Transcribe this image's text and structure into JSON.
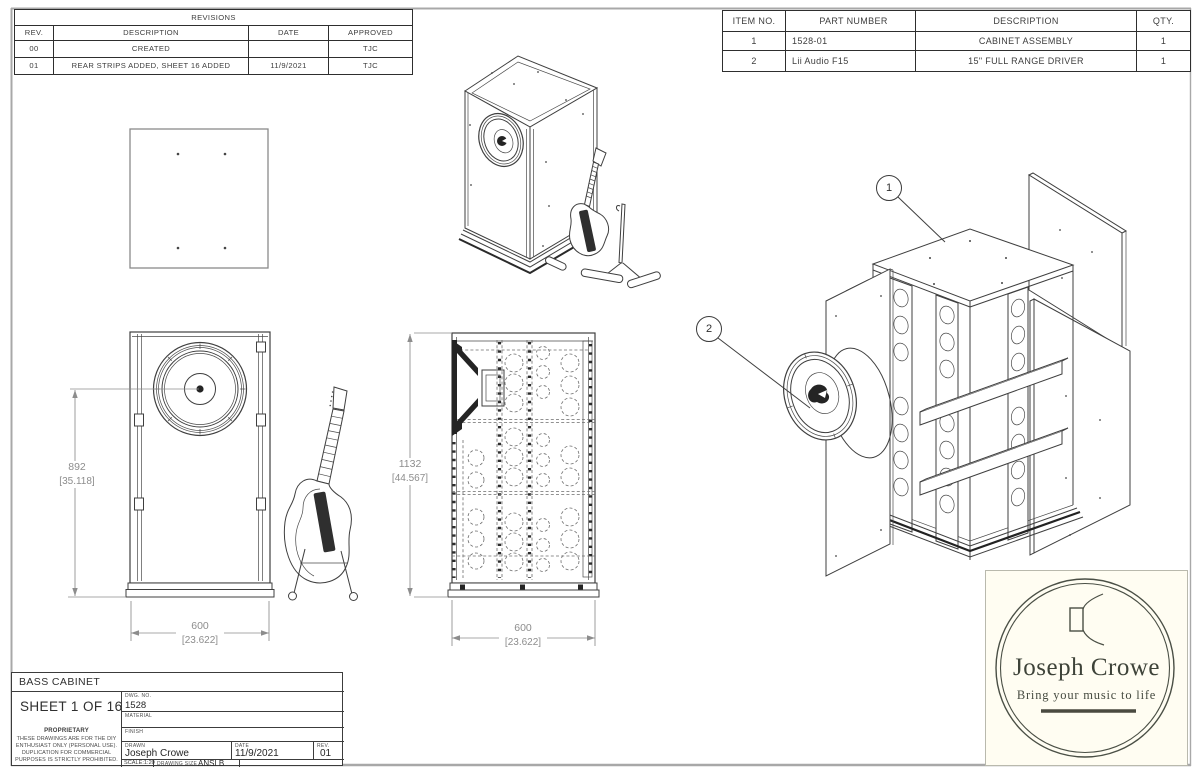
{
  "revisions_table": {
    "title": "REVISIONS",
    "headers": {
      "rev": "REV.",
      "description": "DESCRIPTION",
      "date": "DATE",
      "approved": "APPROVED"
    },
    "rows": [
      {
        "rev": "00",
        "description": "CREATED",
        "date": "",
        "approved": "TJC"
      },
      {
        "rev": "01",
        "description": "REAR STRIPS ADDED, SHEET 16 ADDED",
        "date": "11/9/2021",
        "approved": "TJC"
      }
    ]
  },
  "parts_table": {
    "headers": {
      "item": "ITEM NO.",
      "part": "PART NUMBER",
      "description": "DESCRIPTION",
      "qty": "QTY."
    },
    "rows": [
      {
        "item": "1",
        "part": "1528-01",
        "description": "CABINET ASSEMBLY",
        "qty": "1"
      },
      {
        "item": "2",
        "part": "Lii Audio F15",
        "description": "15\" FULL RANGE DRIVER",
        "qty": "1"
      }
    ]
  },
  "dimensions": {
    "front_height": {
      "value": "892",
      "alt": "[35.118]"
    },
    "front_width": {
      "value": "600",
      "alt": "[23.622]"
    },
    "section_height": {
      "value": "1132",
      "alt": "[44.567]"
    },
    "section_width": {
      "value": "600",
      "alt": "[23.622]"
    }
  },
  "callouts": [
    {
      "label": "1"
    },
    {
      "label": "2"
    }
  ],
  "title_block": {
    "project": "BASS CABINET",
    "sheet": "SHEET 1 OF 16",
    "dwg_no_label": "DWG.  NO.",
    "dwg_no": "1528",
    "material_label": "MATERIAL",
    "finish_label": "FINISH",
    "drawn_label": "DRAWN",
    "drawn_by": "Joseph Crowe",
    "date_label": "DATE",
    "date": "11/9/2021",
    "rev_label": "REV.",
    "rev": "01",
    "scale": "SCALE:1:20",
    "drawing_size_label": "DRAWING SIZE",
    "drawing_size": "ANSI B",
    "proprietary_title": "PROPRIETARY",
    "proprietary_lines": [
      "THESE DRAWINGS ARE FOR THE DIY",
      "ENTHUSIAST ONLY (PERSONAL USE).",
      "DUPLICATION FOR COMMERCIAL",
      "PURPOSES IS STRICTLY PROHIBITED."
    ]
  },
  "logo": {
    "name": "Joseph Crowe",
    "tagline": "Bring your music to life"
  },
  "colors": {
    "line": "#3f3f3f",
    "dim_text": "#8d8d8d",
    "logo_ink": "#3e4339",
    "logo_bg": "#fffdf2",
    "table_border": "#2e2e2e",
    "frame": "#a8a8a8"
  }
}
